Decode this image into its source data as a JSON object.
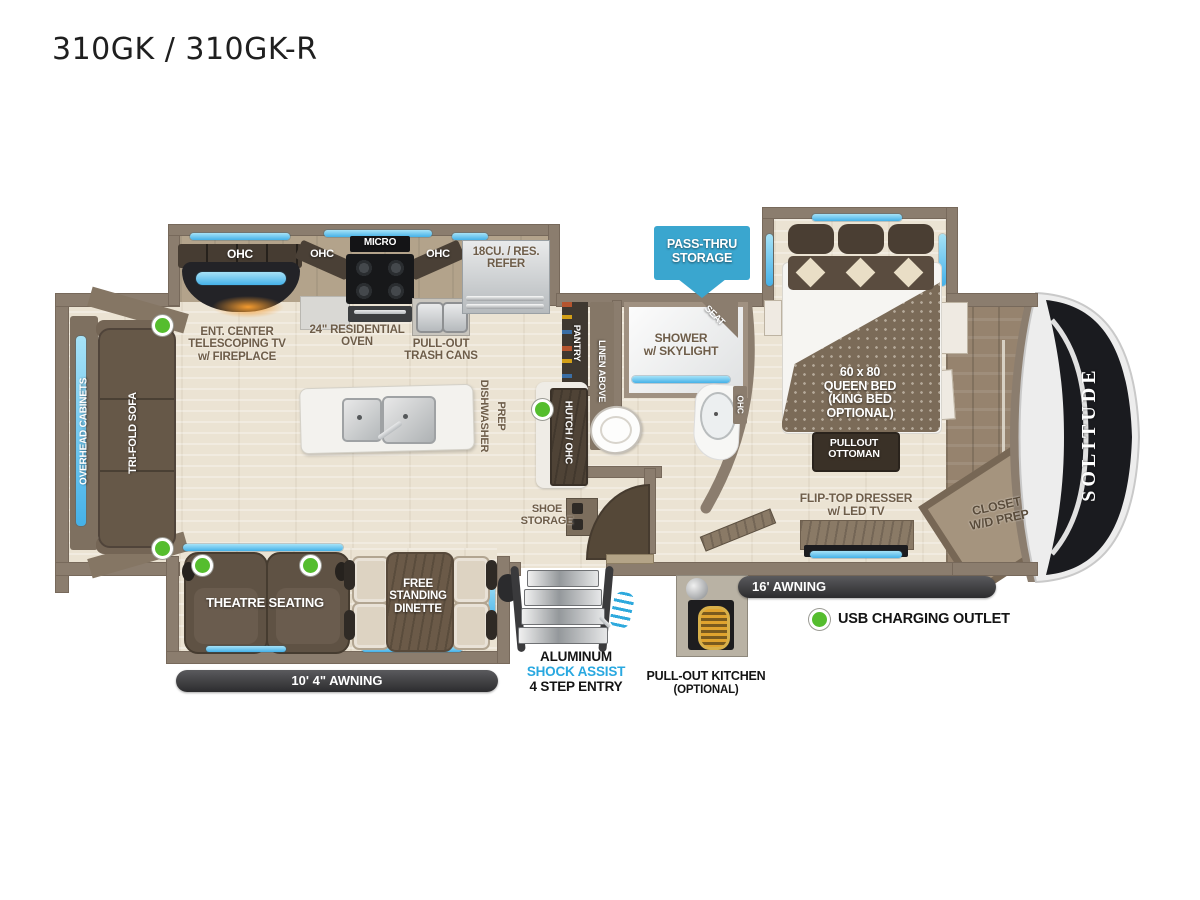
{
  "title": "310GK / 310GK-R",
  "living": {
    "overhead_cabinets": "OVERHEAD CABINETS",
    "trifold_sofa": "TRI-FOLD SOFA",
    "theatre_seating": "THEATRE SEATING",
    "dinette": "FREE\nSTANDING\nDINETTE"
  },
  "kitchen": {
    "ohc": "OHC",
    "micro": "MICRO",
    "refer": "18CU. / RES.\nREFER",
    "ent_center": "ENT. CENTER\nTELESCOPING TV\nw/ FIREPLACE",
    "oven": "24\" RESIDENTIAL\nOVEN",
    "trash": "PULL-OUT\nTRASH CANS",
    "dishwasher": "DISHWASHER",
    "prep": "PREP"
  },
  "bath": {
    "pantry": "PANTRY",
    "linen_above": "LINEN ABOVE",
    "shower": "SHOWER\nw/ SKYLIGHT",
    "seat": "SEAT",
    "ohc": "OHC",
    "hutch": "HUTCH / OHC",
    "shoe_storage": "SHOE\nSTORAGE"
  },
  "bedroom": {
    "bed": "60 x 80\nQUEEN BED\n(KING BED\nOPTIONAL)",
    "ottoman": "PULLOUT\nOTTOMAN",
    "dresser": "FLIP-TOP DRESSER\nw/ LED TV",
    "closet": "CLOSET\nW/D PREP"
  },
  "entry": {
    "aluminum": "ALUMINUM",
    "shock_assist": "SHOCK ASSIST",
    "step_entry": "4 STEP ENTRY",
    "pullout_kitchen": "PULL-OUT KITCHEN",
    "optional": "(OPTIONAL)"
  },
  "awnings": {
    "left": "10' 4\"  AWNING",
    "right": "16' AWNING"
  },
  "callouts": {
    "pass_thru": "PASS-THRU\nSTORAGE"
  },
  "legend": {
    "usb": "USB CHARGING OUTLET"
  },
  "brand": {
    "logo": "SOLITUDE"
  },
  "colors": {
    "accent_blue": "#45b1e8",
    "callout_blue": "#3aa6cf",
    "usb_green": "#55bd2e",
    "awning_dark": "#3a3a3c",
    "wall_taupe": "#8b7d6e",
    "label_brown": "#6e5d49"
  }
}
